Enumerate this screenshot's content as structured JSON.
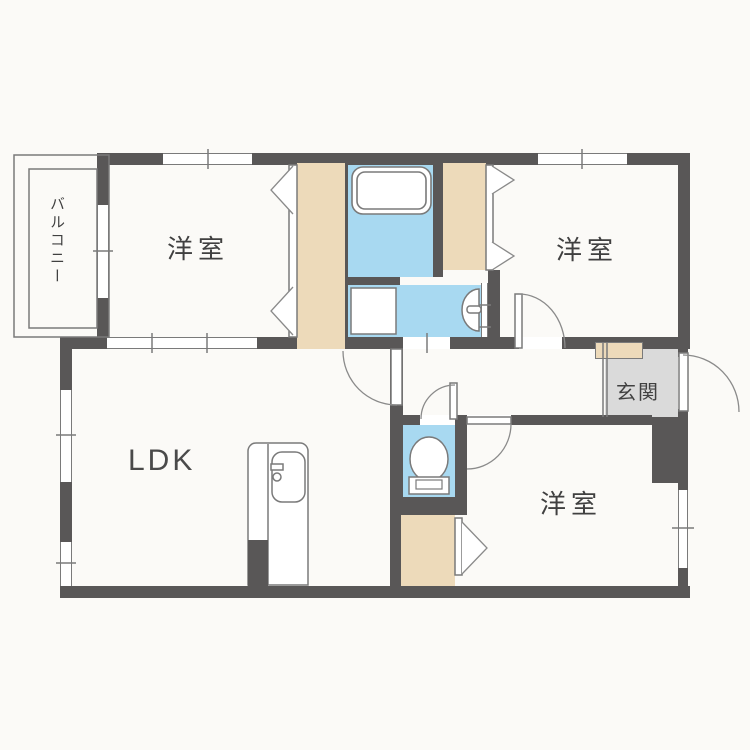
{
  "plan": {
    "type": "japanese-apartment-floor-plan",
    "labels": {
      "balcony": "バルコニー",
      "room_nw": "洋室",
      "room_ne": "洋室",
      "room_se": "洋室",
      "ldk": "LDK",
      "entrance": "玄関"
    },
    "colors": {
      "wall": "#595757",
      "water": "#a8d9f1",
      "closet": "#eddaba",
      "entrance_floor": "#dadada",
      "line": "#7a7a7a",
      "text": "#404040",
      "background": "#fbfaf7"
    },
    "fixtures": [
      "bathtub",
      "washing-machine-pan",
      "washbasin",
      "toilet",
      "kitchen-sink",
      "shoe-cabinet"
    ]
  }
}
